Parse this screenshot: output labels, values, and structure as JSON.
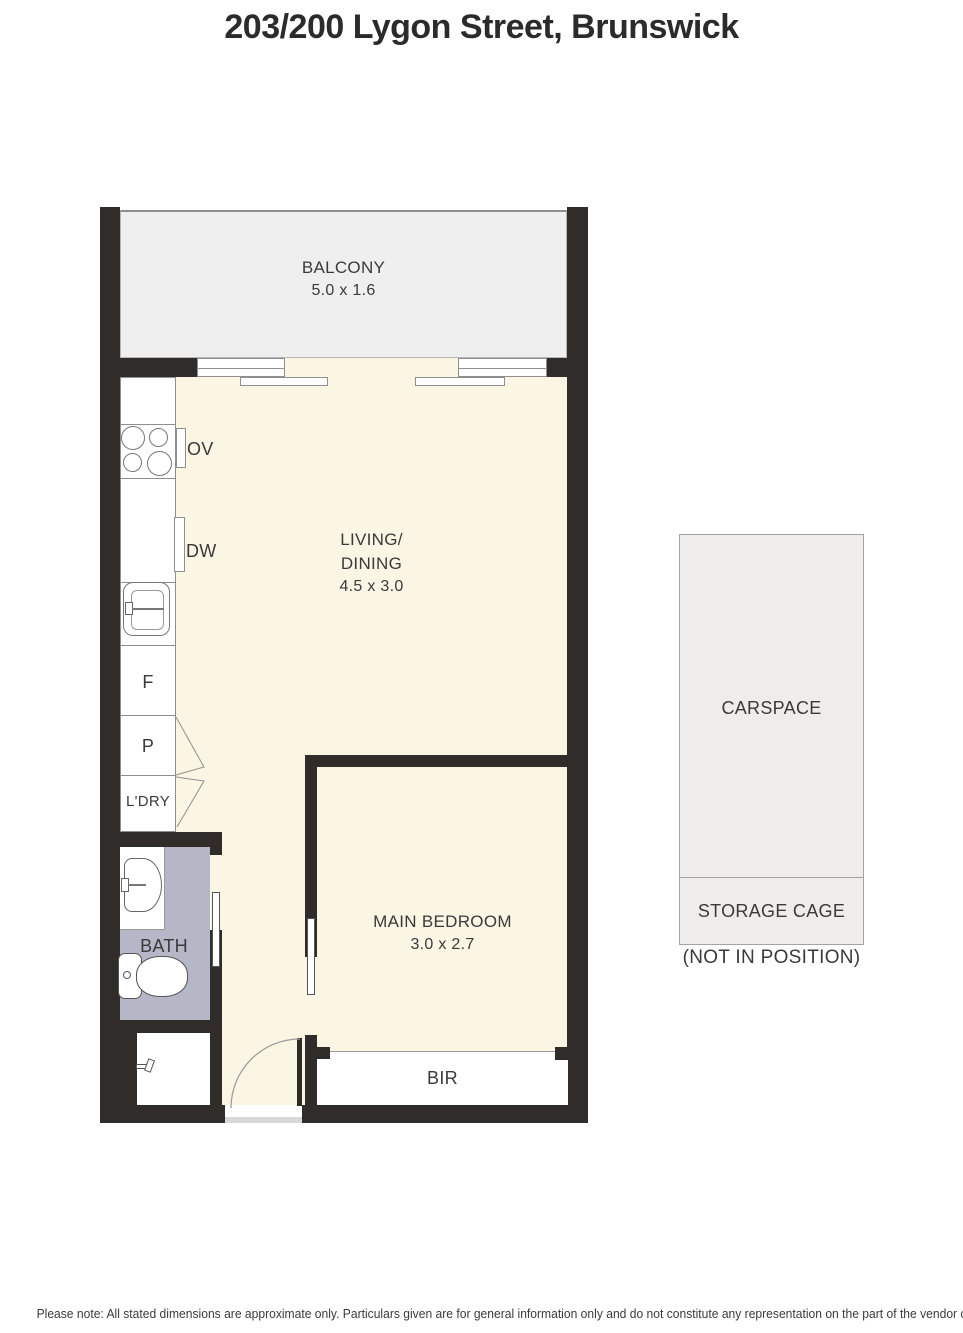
{
  "title": "203/200 Lygon Street, Brunswick",
  "plan": {
    "balcony": {
      "label": "BALCONY",
      "dims": "5.0 x 1.6"
    },
    "living": {
      "line1": "LIVING/",
      "line2": "DINING",
      "dims": "4.5 x 3.0"
    },
    "bedroom": {
      "label": "MAIN BEDROOM",
      "dims": "3.0 x 2.7"
    },
    "bath": {
      "label": "BATH"
    },
    "bir": {
      "label": "BIR"
    },
    "kitchen": {
      "oven": "OV",
      "dishwasher": "DW",
      "fridge": "F",
      "pantry": "P",
      "laundry": "L'DRY"
    }
  },
  "parking": {
    "carspace": {
      "label": "CARSPACE"
    },
    "storage": {
      "label": "STORAGE CAGE"
    },
    "note": "(NOT IN POSITION)"
  },
  "footer": {
    "disclaimer": "Please note: All stated dimensions are approximate only. Particulars given are for general information only and do not constitute any representation on the part of the vendor or agent."
  },
  "colors": {
    "wall": "#302c29",
    "floor": "#fbf5e4",
    "balcony_floor": "#efefef",
    "bath_floor": "#b5b7c6",
    "carspace_fill": "#eeedec"
  }
}
